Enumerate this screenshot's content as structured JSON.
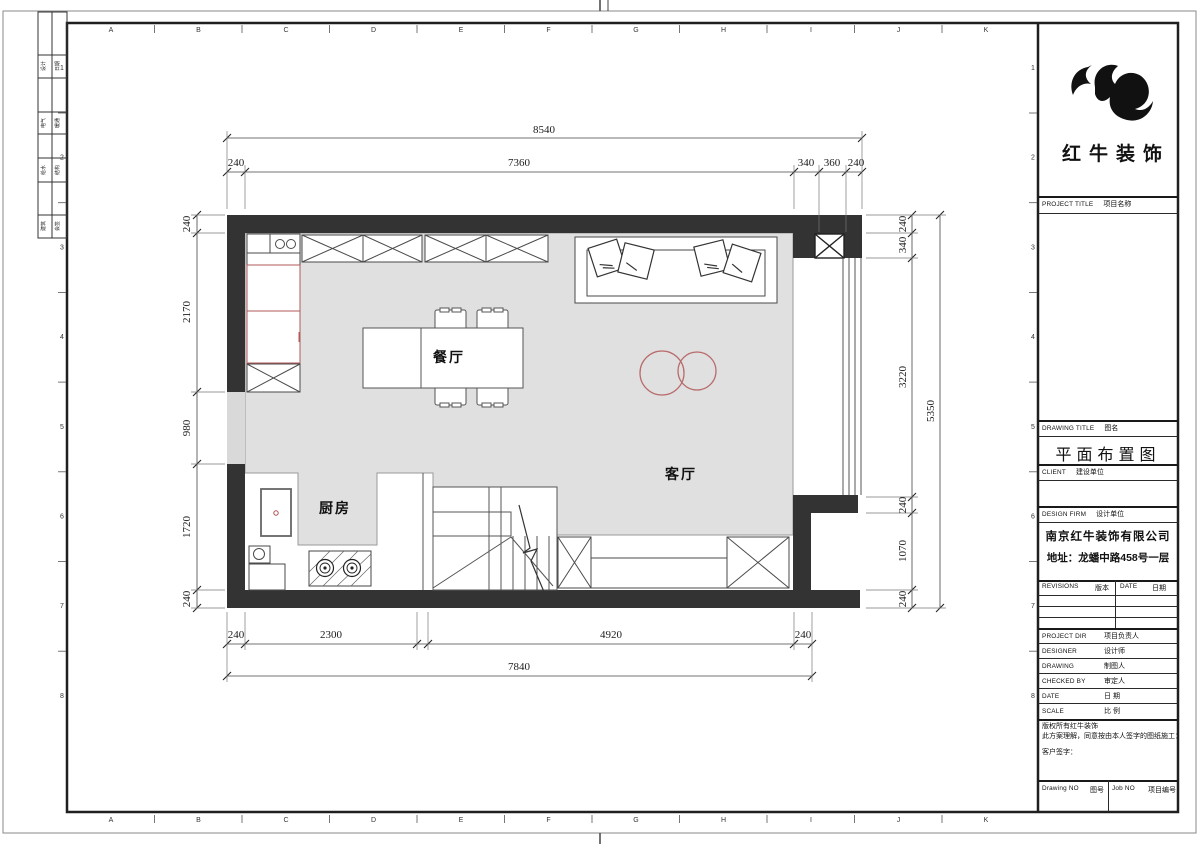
{
  "sheet": {
    "grid_columns": [
      "A",
      "B",
      "C",
      "D",
      "E",
      "F",
      "G",
      "H",
      "I",
      "J",
      "K"
    ],
    "grid_rows": [
      "1",
      "2",
      "3",
      "4",
      "5",
      "6",
      "7",
      "8"
    ],
    "signature_table": [
      {
        "c1": "设计",
        "c2": "日期"
      },
      {
        "c1": "电气",
        "c2": "暖通"
      },
      {
        "c1": "给水",
        "c2": "结构"
      },
      {
        "c1": "建筑",
        "c2": "会签"
      }
    ]
  },
  "plan": {
    "rooms": {
      "dining": "餐厅",
      "living": "客厅",
      "kitchen": "厨房"
    },
    "dimensions": {
      "top_total": "8540",
      "top_segments": [
        "240",
        "7360",
        "340",
        "360",
        "240"
      ],
      "left_segments": [
        "240",
        "2170",
        "980",
        "1720",
        "240"
      ],
      "right_segments": [
        "240",
        "340",
        "3220",
        "240",
        "1070",
        "240"
      ],
      "right_total": "5350",
      "bottom_segments": [
        "240",
        "2300",
        "4920",
        "240"
      ],
      "bottom_total": "7840"
    }
  },
  "title_block": {
    "logo_text": "红牛装饰",
    "project_title_en": "PROJECT TITLE",
    "project_title_cn": "项目名称",
    "drawing_title_en": "DRAWING TITLE",
    "drawing_title_cn": "图名",
    "drawing_title_value": "平面布置图",
    "client_en": "CLIENT",
    "client_cn": "建设单位",
    "design_firm_en": "DESIGN FIRM",
    "design_firm_cn": "设计单位",
    "firm_name": "南京红牛装饰有限公司",
    "firm_address": "地址：龙蟠中路458号一层",
    "revisions_en": "REVISIONS",
    "revisions_cn": "版本",
    "date_header_en": "DATE",
    "date_header_cn": "日期",
    "project_dir_en": "PROJECT DIR",
    "project_dir_cn": "项目负责人",
    "designer_en": "DESIGNER",
    "designer_cn": "设计师",
    "drawing_en": "DRAWING",
    "drawing_cn": "制图人",
    "checked_en": "CHECKED BY",
    "checked_cn": "审定人",
    "date_en": "DATE",
    "date_cn": "日 期",
    "scale_en": "SCALE",
    "scale_cn": "比 例",
    "copyright_line1": "版权所有红牛装饰",
    "copyright_line2": "此方案理解，同意按由本人签字的图纸施工：",
    "copyright_line3": "客户签字：",
    "drawing_no_en": "Drawing NO",
    "drawing_no_cn": "图号",
    "job_no_en": "Job NO",
    "job_no_cn": "项目编号"
  },
  "colors": {
    "wall": "#333333",
    "floor": "#e0e0e0",
    "accent_red": "#b96a6a"
  }
}
